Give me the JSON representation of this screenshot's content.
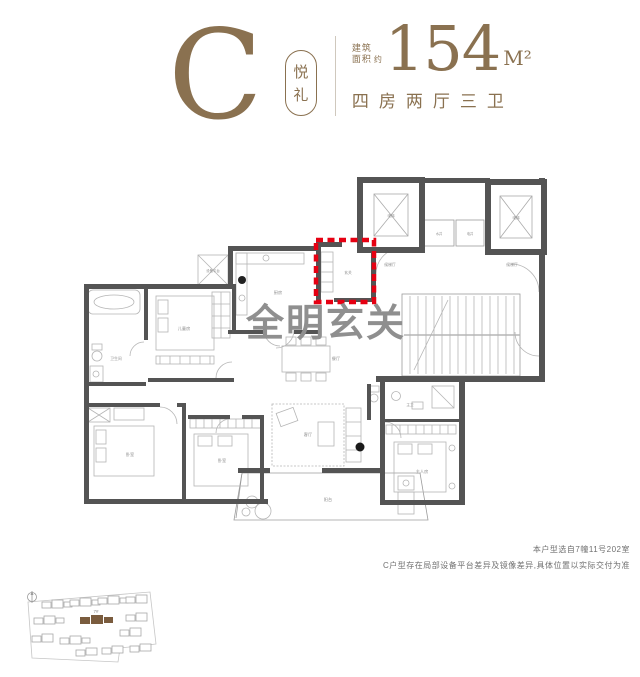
{
  "header": {
    "type_letter": "C",
    "type_name": "悦礼",
    "type_name_chars": [
      "悦",
      "礼"
    ],
    "area_prefix_line1": "建筑",
    "area_prefix_line2": "面积",
    "area_approx": "约",
    "area_value": "154",
    "area_unit": "M²",
    "layout_summary": "四房两厅三卫",
    "accent_color": "#8a7150"
  },
  "floorplan": {
    "callout": {
      "text": "全明玄关",
      "color": "#e60012"
    },
    "room_labels": {
      "equipment_platform": "设备平台",
      "bath": "卫生间",
      "kids_room": "儿童房",
      "kitchen": "厨房",
      "foyer": "玄关",
      "elevator_left": "电梯",
      "elevator_right": "电梯",
      "water_shaft": "水井",
      "electric_shaft": "电井",
      "elevator_hall_left": "候梯厅",
      "elevator_hall_right": "候梯厅",
      "dining": "餐厅",
      "living": "客厅",
      "balcony": "阳台",
      "bedroom_left": "卧室",
      "bedroom_mid": "卧室",
      "master_bath": "主卫",
      "master_bedroom": "主人房"
    }
  },
  "notes": {
    "line1": "本户型选自7幢11号202室",
    "line2": "C户型存在局部设备平台差异及镜像差异,具体位置以实际交付为准"
  },
  "siteplan": {
    "highlighted_building": "7#",
    "highlight_color": "#7a5c3e"
  }
}
